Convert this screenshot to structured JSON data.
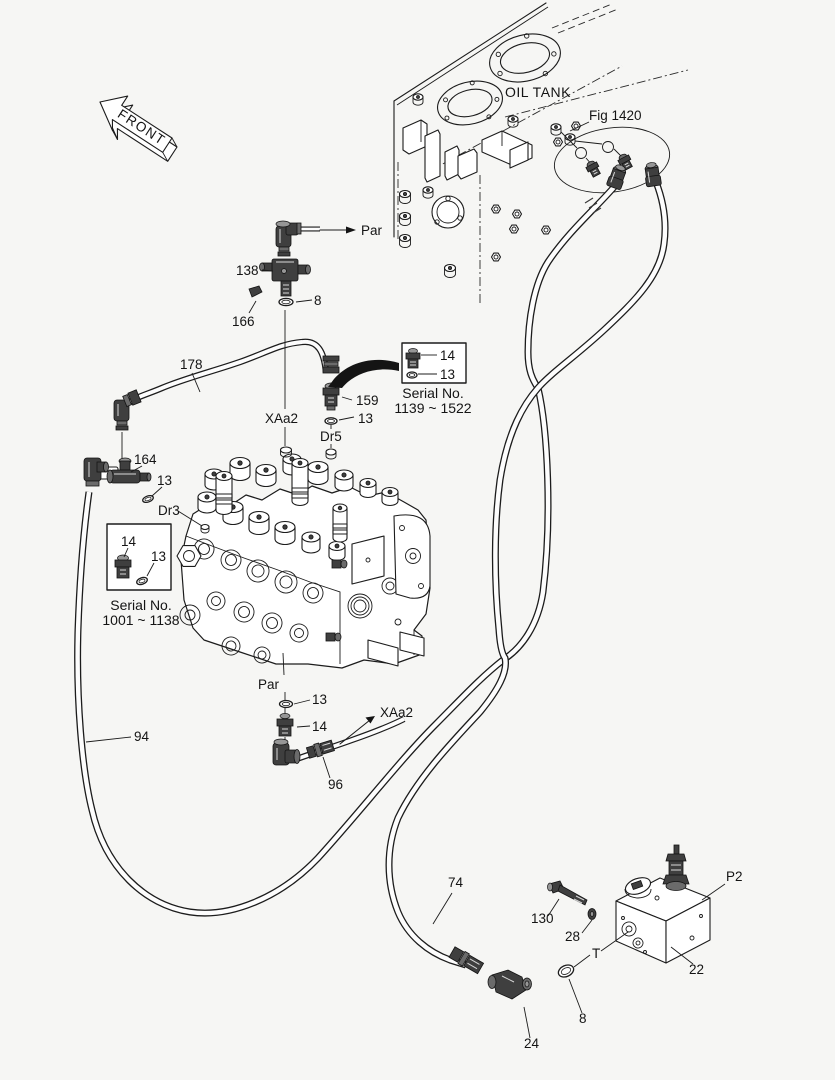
{
  "figure": {
    "front_marker": "FRONT",
    "oil_tank": "OIL TANK",
    "figure_ref": "Fig 1420"
  },
  "ports": {
    "par_top": "Par",
    "par_bottom": "Par",
    "xaa2_mid": "XAa2",
    "xaa2_bottom": "XAa2",
    "dr5": "Dr5",
    "dr3": "Dr3",
    "t": "T",
    "p2": "P2"
  },
  "parts": {
    "tee_138": "138",
    "plug_166": "166",
    "oring_8_top": "8",
    "hose_178": "178",
    "adapter_159": "159",
    "oring_13_dr5": "13",
    "tee_164": "164",
    "oring_13_dr3": "13",
    "hose_94": "94",
    "oring_13_par": "13",
    "adapter_14_par": "14",
    "hose_96": "96",
    "hose_74": "74",
    "bolt_130": "130",
    "washer_28": "28",
    "valve_22": "22",
    "oring_8_bottom": "8",
    "elbow_24": "24"
  },
  "serial_boxes": {
    "upper": {
      "fitting": "14",
      "oring": "13",
      "caption_line1": "Serial No.",
      "caption_line2": "1139 ~ 1522"
    },
    "lower": {
      "fitting": "14",
      "oring": "13",
      "caption_line1": "Serial No.",
      "caption_line2": "1001 ~ 1138"
    }
  },
  "colors": {
    "background": "#f6f6f4",
    "line_ink": "#1c1c1c",
    "fitting_dark": "#3f3f3f",
    "text": "#141414"
  }
}
